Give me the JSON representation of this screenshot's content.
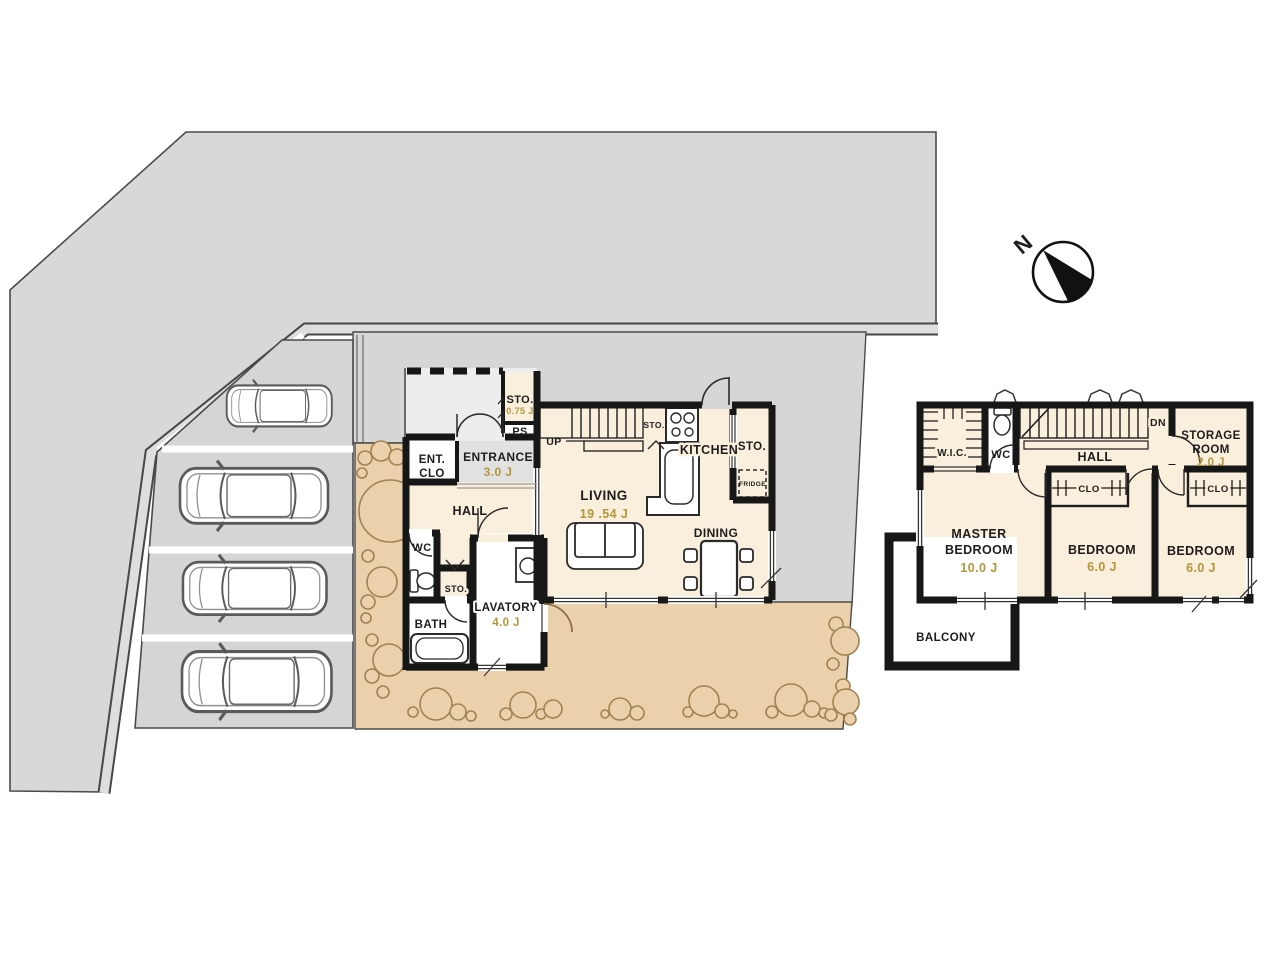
{
  "compass": {
    "north_label": "N"
  },
  "floor1": {
    "rooms": {
      "sto_porch": {
        "label": "STO.",
        "area": "0.75 J"
      },
      "ps": {
        "label": "PS"
      },
      "ent_clo": {
        "line1": "ENT.",
        "line2": "CLO"
      },
      "entrance": {
        "label": "ENTRANCE",
        "area": "3.0 J"
      },
      "hall": {
        "label": "HALL"
      },
      "stairs_up": {
        "label": "UP"
      },
      "sto_stair": {
        "label": "STO."
      },
      "kitchen": {
        "label": "KITCHEN"
      },
      "sto_kitchen": {
        "label": "STO."
      },
      "fridge": {
        "label": "FRIDGE"
      },
      "living": {
        "label": "LIVING",
        "area": "19 .54 J"
      },
      "dining": {
        "label": "DINING"
      },
      "wc": {
        "label": "WC"
      },
      "sto_hall": {
        "label": "STO."
      },
      "lavatory": {
        "label": "LAVATORY",
        "area": "4.0 J"
      },
      "bath": {
        "label": "BATH"
      }
    }
  },
  "floor2": {
    "rooms": {
      "wic": {
        "label": "W.I.C."
      },
      "wc": {
        "label": "WC"
      },
      "hall": {
        "label": "HALL"
      },
      "stairs_dn": {
        "label": "DN"
      },
      "storage": {
        "line1": "STORAGE",
        "line2": "ROOM",
        "area": "2.0 J"
      },
      "clo_left": {
        "label": "CLO"
      },
      "clo_right": {
        "label": "CLO"
      },
      "master": {
        "line1": "MASTER",
        "line2": "BEDROOM",
        "area": "10.0 J"
      },
      "bedroom_center": {
        "label": "BEDROOM",
        "area": "6.0 J"
      },
      "bedroom_right": {
        "label": "BEDROOM",
        "area": "6.0 J"
      },
      "balcony": {
        "label": "BALCONY"
      }
    }
  },
  "site": {
    "parking_spaces": 4,
    "colors": {
      "road": "#d8d8d8",
      "curb": "#dedede",
      "parking": "#d5d5d5",
      "garden": "#ead1ac",
      "bush_outline": "#a0powder",
      "bush_stroke": "#a08253",
      "room_cream": "#f9efdc",
      "entrance_floor": "#e1e1e1",
      "porch": "#ededed",
      "wall": "#171717",
      "area_text_gold": "#b3953a"
    }
  }
}
